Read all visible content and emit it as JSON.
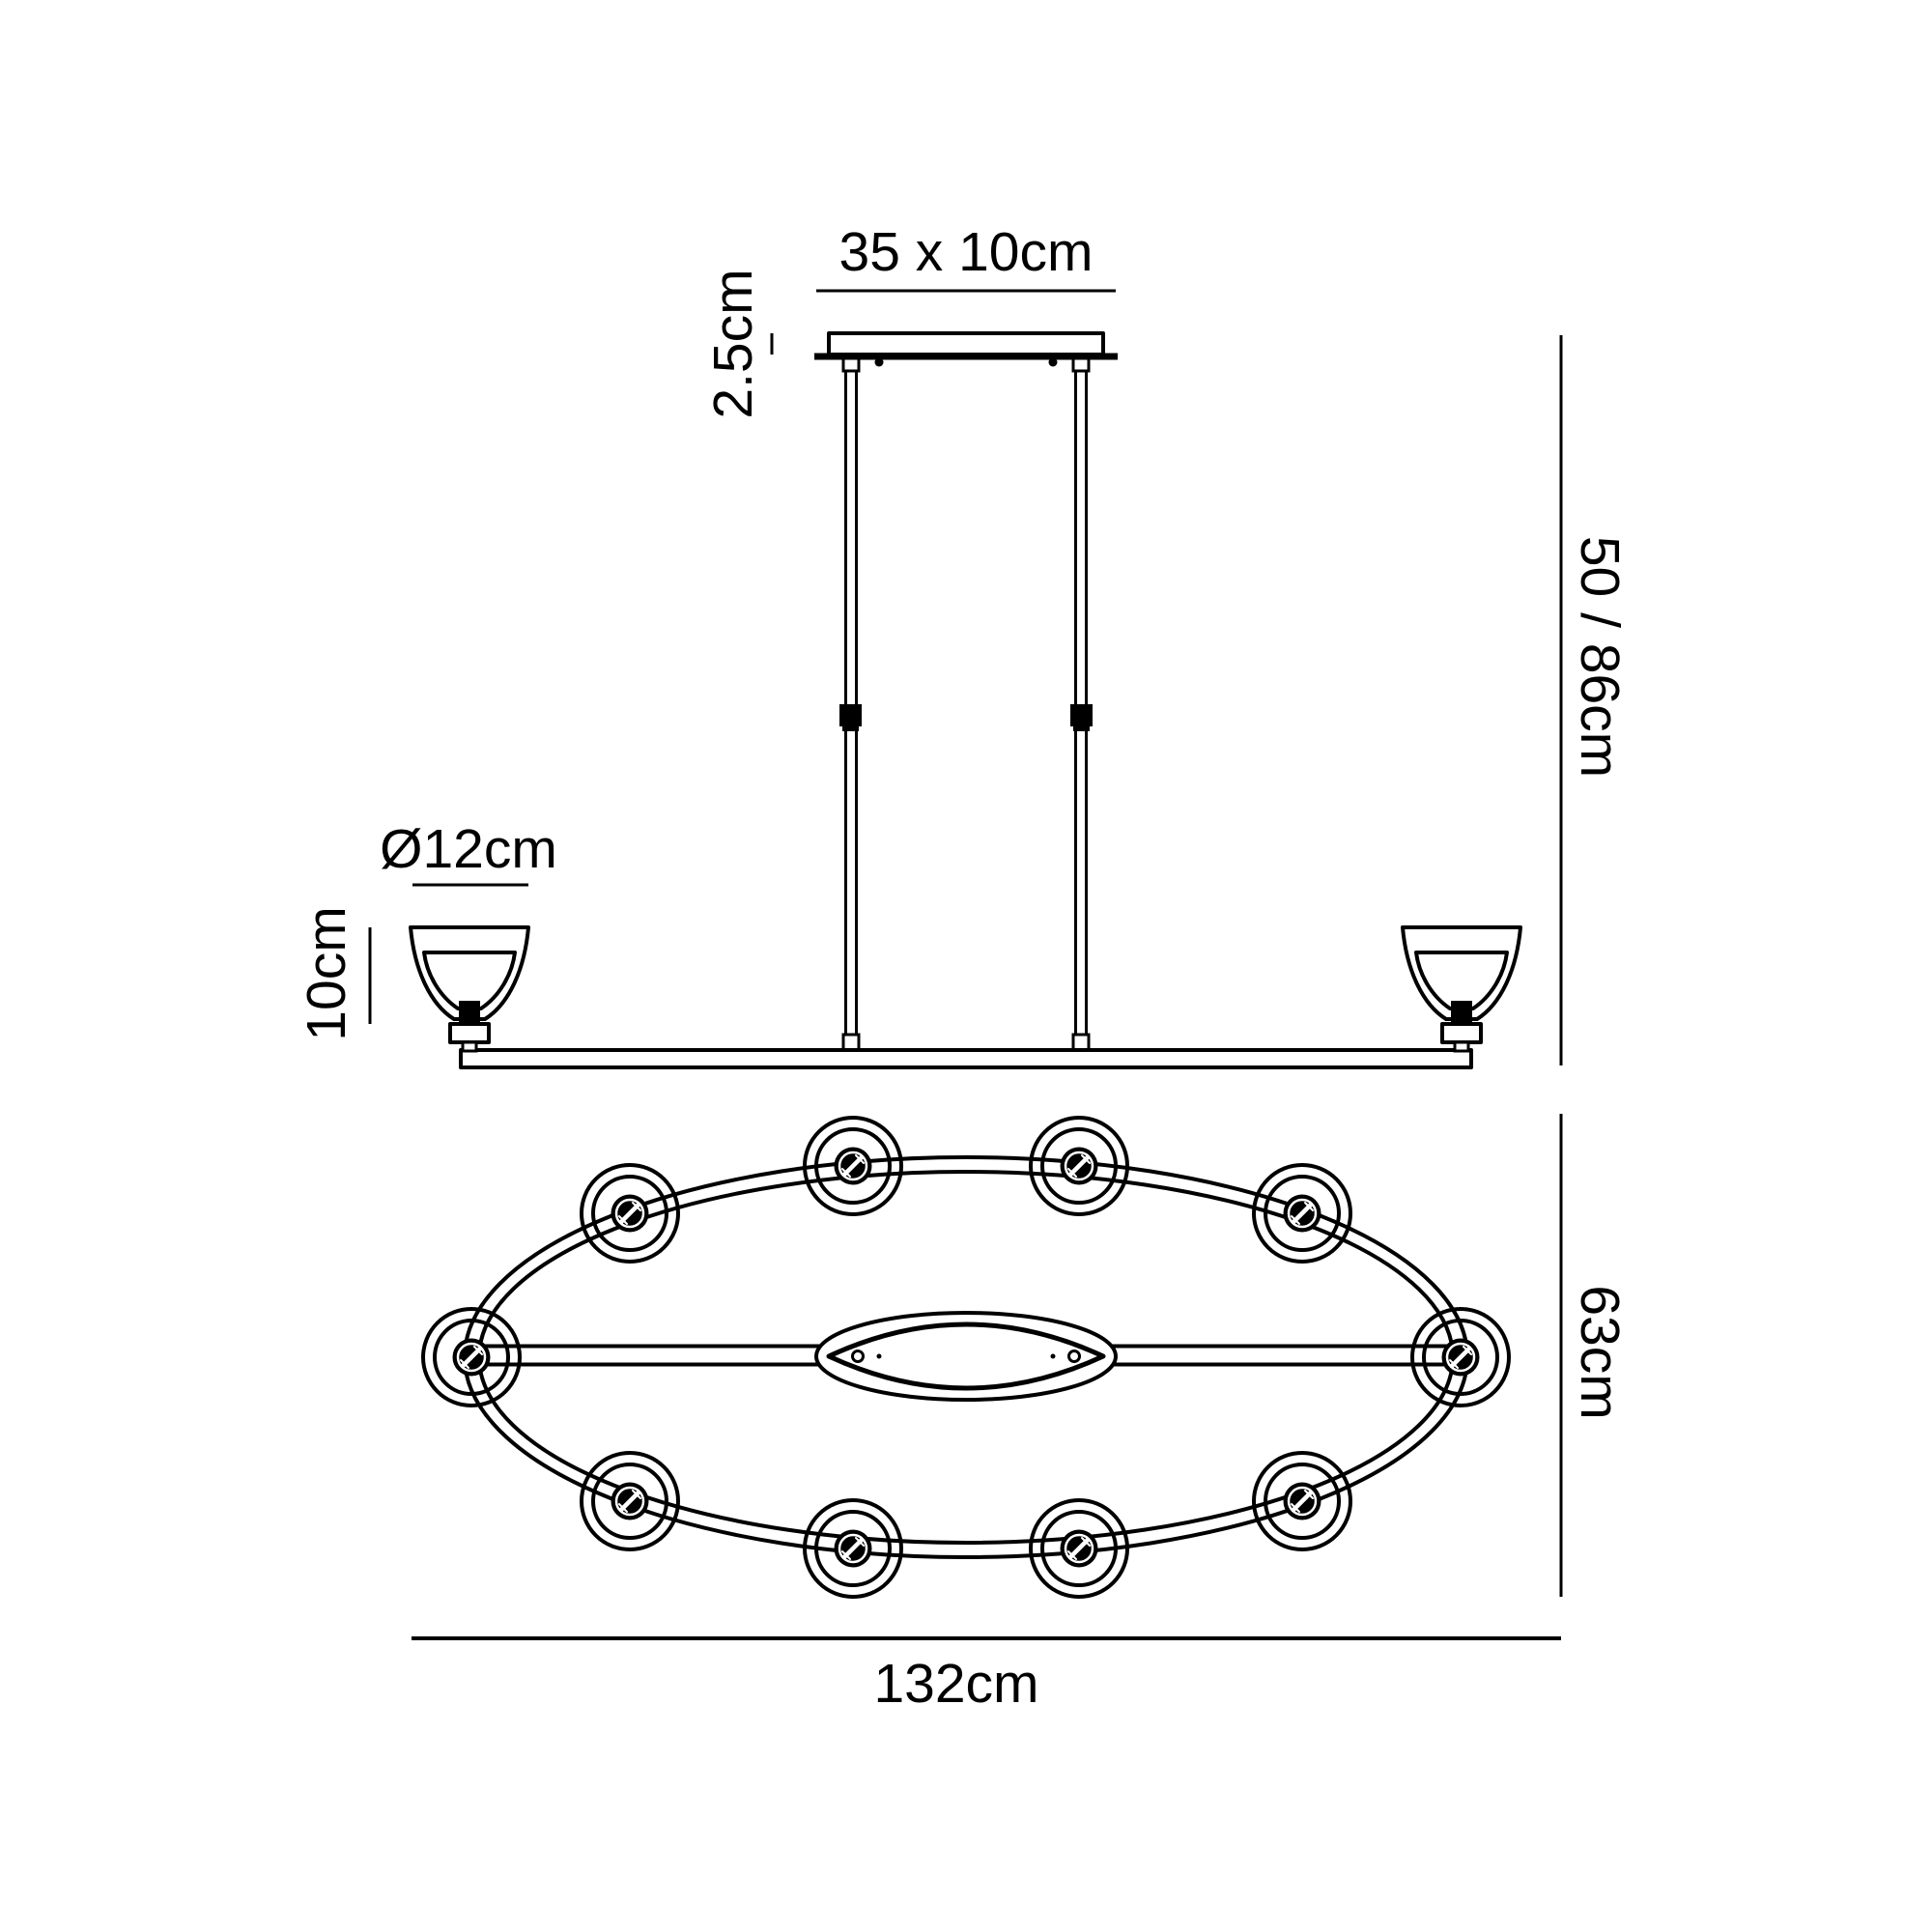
{
  "colors": {
    "line": "#000000",
    "background": "#ffffff"
  },
  "side_view": {
    "canopy_size_label": "35 x 10cm",
    "canopy_height_label": "2.5cm",
    "shade_diameter_label": "Ø12cm",
    "shade_height_label": "10cm",
    "drop_height_label": "50 / 86cm"
  },
  "plan_view": {
    "depth_label": "63cm",
    "width_label": "132cm",
    "light_count": 10
  }
}
